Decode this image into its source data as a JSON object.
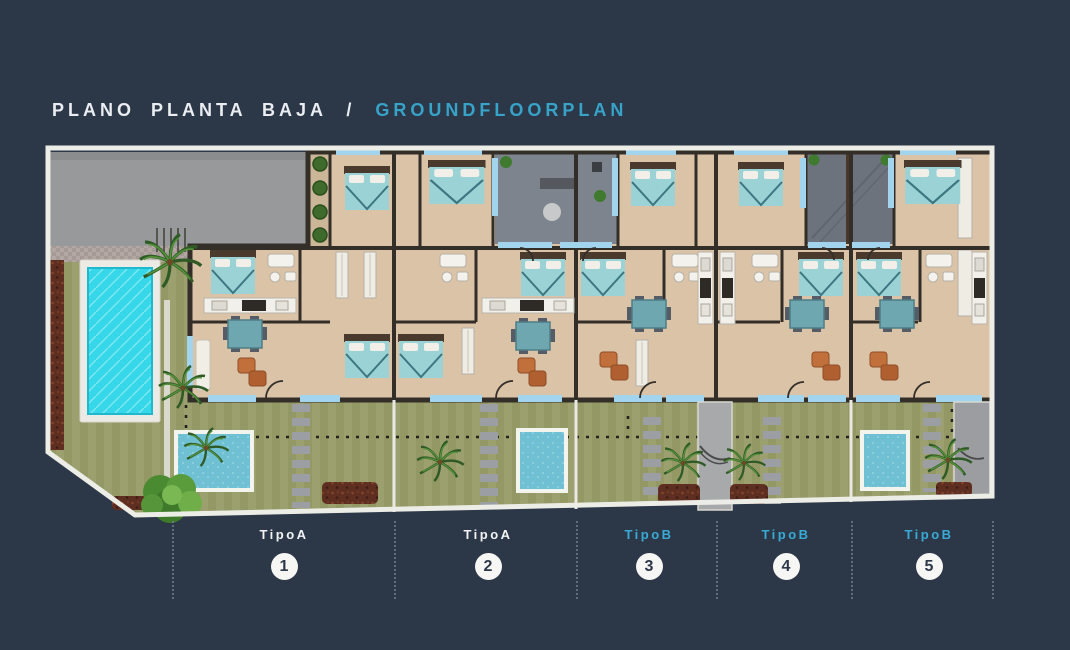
{
  "header": {
    "title_es": "PLANO PLANTA BAJA",
    "title_sep": "/",
    "title_en": "GROUNDFLOORPLAN",
    "title_es_color": "#EAEDF1",
    "title_en_color": "#37A3C9"
  },
  "background_color": "#2C3748",
  "accent_color": "#37A3C9",
  "units": [
    {
      "label": "TipoA",
      "number": "1",
      "label_color": "#F2F4F6"
    },
    {
      "label": "TipoA",
      "number": "2",
      "label_color": "#F2F4F6"
    },
    {
      "label": "TipoB",
      "number": "3",
      "label_color": "#38ACD6"
    },
    {
      "label": "TipoB",
      "number": "4",
      "label_color": "#38ACD6"
    },
    {
      "label": "TipoB",
      "number": "5",
      "label_color": "#38ACD6"
    }
  ]
}
